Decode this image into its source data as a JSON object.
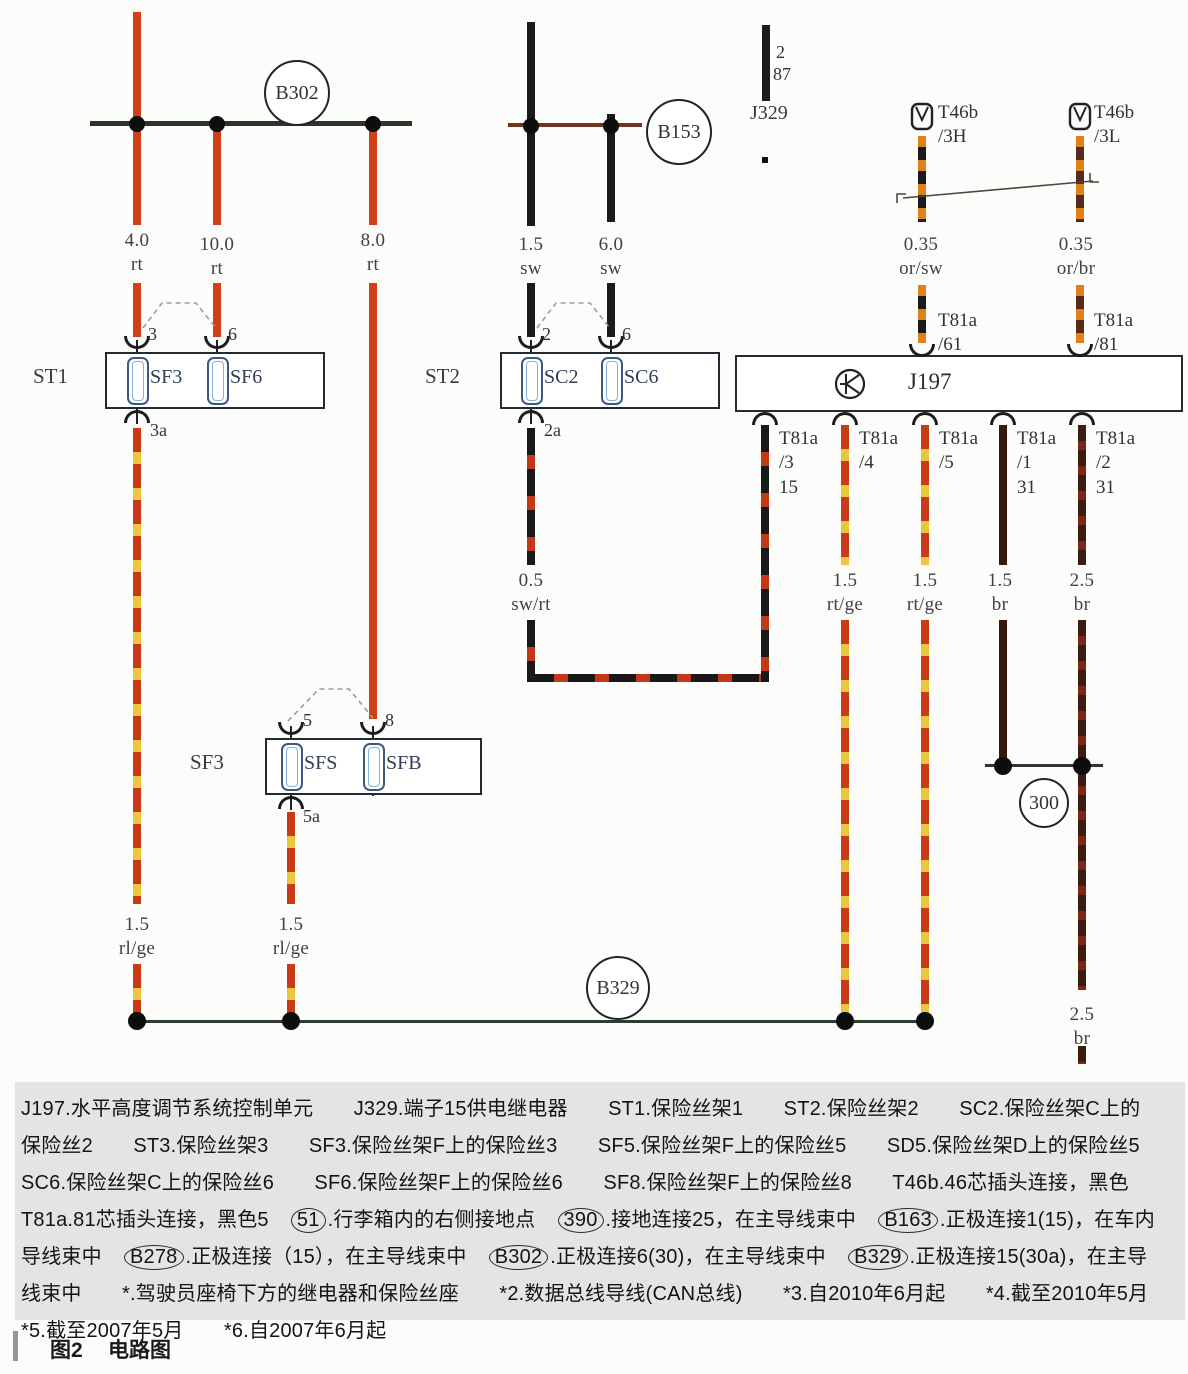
{
  "diagram": {
    "b302": "B302",
    "b153": "B153",
    "b329": "B329",
    "ground_300": "300",
    "j329": {
      "pin": "2",
      "terminal": "87",
      "name": "J329"
    },
    "t46b_left": {
      "name": "T46b",
      "pin": "/3H"
    },
    "t46b_right": {
      "name": "T46b",
      "pin": "/3L"
    },
    "wire_labels": {
      "w40": {
        "size": "4.0",
        "code": "rt"
      },
      "w100": {
        "size": "10.0",
        "code": "rt"
      },
      "w80": {
        "size": "8.0",
        "code": "rt"
      },
      "w15sw": {
        "size": "1.5",
        "code": "sw"
      },
      "w60sw": {
        "size": "6.0",
        "code": "sw"
      },
      "w035orsw": {
        "size": "0.35",
        "code": "or/sw"
      },
      "w035orbr": {
        "size": "0.35",
        "code": "or/br"
      },
      "w05swrt": {
        "size": "0.5",
        "code": "sw/rt"
      },
      "w15rtge_1": {
        "size": "1.5",
        "code": "rt/ge"
      },
      "w15rtge_2": {
        "size": "1.5",
        "code": "rt/ge"
      },
      "w15br": {
        "size": "1.5",
        "code": "br"
      },
      "w25br": {
        "size": "2.5",
        "code": "br"
      },
      "w15rlge_1": {
        "size": "1.5",
        "code": "rl/ge"
      },
      "w15rlge_2": {
        "size": "1.5",
        "code": "rl/ge"
      },
      "w25br_end": {
        "size": "2.5",
        "code": "br"
      }
    },
    "st1": {
      "label": "ST1",
      "fuse1": "SF3",
      "fuse2": "SF6",
      "pin1": "3",
      "pin2": "6",
      "pin_out": "3a"
    },
    "st2": {
      "label": "ST2",
      "fuse1": "SC2",
      "fuse2": "SC6",
      "pin1": "2",
      "pin2": "6",
      "pin_out": "2a"
    },
    "sf3": {
      "label": "SF3",
      "fuse1": "SFS",
      "fuse2": "SFB",
      "pin1": "5",
      "pin2": "8",
      "pin_out": "5a"
    },
    "j197": {
      "label": "J197",
      "pin61": {
        "name": "T81a",
        "pin": "/61"
      },
      "pin81": {
        "name": "T81a",
        "pin": "/81"
      },
      "pin3": {
        "name": "T81a",
        "pin": "/3",
        "terminal": "15"
      },
      "pin4": {
        "name": "T81a",
        "pin": "/4"
      },
      "pin5": {
        "name": "T81a",
        "pin": "/5"
      },
      "pin1": {
        "name": "T81a",
        "pin": "/1",
        "terminal": "31"
      },
      "pin2": {
        "name": "T81a",
        "pin": "/2",
        "terminal": "31"
      }
    }
  },
  "legend": {
    "lines": [
      [
        {
          "t": "J197.水平高度调节系统控制单元　　J329.端子15供电继电器　　ST1.保险丝架1　　ST2.保险丝架2　　SC2.保险丝架C上的"
        }
      ],
      [
        {
          "t": "保险丝2　　ST3.保险丝架3　　SF3.保险丝架F上的保险丝3　　SF5.保险丝架F上的保险丝5　　SD5.保险丝架D上的保险丝5"
        }
      ],
      [
        {
          "t": "SC6.保险丝架C上的保险丝6　　SF6.保险丝架F上的保险丝6　　SF8.保险丝架F上的保险丝8　　T46b.46芯插头连接，黑色"
        }
      ],
      [
        {
          "t": "T81a.81芯插头连接，黑色5　"
        },
        {
          "t": "51",
          "c": true
        },
        {
          "t": ".行李箱内的右侧接地点　"
        },
        {
          "t": "390",
          "c": true
        },
        {
          "t": ".接地连接25，在主导线束中　"
        },
        {
          "t": "B163",
          "c": true
        },
        {
          "t": ".正极连接1(15)，在车内"
        }
      ],
      [
        {
          "t": "导线束中　"
        },
        {
          "t": "B278",
          "c": true
        },
        {
          "t": ".正极连接（15），在主导线束中　"
        },
        {
          "t": "B302",
          "c": true
        },
        {
          "t": ".正极连接6(30)，在主导线束中　"
        },
        {
          "t": "B329",
          "c": true
        },
        {
          "t": ".正极连接15(30a)，在主导"
        }
      ],
      [
        {
          "t": "线束中　　*.驾驶员座椅下方的继电器和保险丝座　　*2.数据总线导线(CAN总线)　　*3.自2010年6月起　　*4.截至2010年5月"
        }
      ],
      [
        {
          "t": "*5.截至2007年5月　　*6.自2007年6月起"
        }
      ]
    ]
  },
  "caption": {
    "fig": "图2",
    "title": "电路图"
  },
  "colors": {
    "wire_red": "#d04018",
    "wire_black": "#1b1b1b",
    "wire_yellow": "#e9c83d",
    "wire_orange": "#e0821c",
    "wire_brown": "#37190e",
    "legend_bg": "#e4e4e7"
  }
}
